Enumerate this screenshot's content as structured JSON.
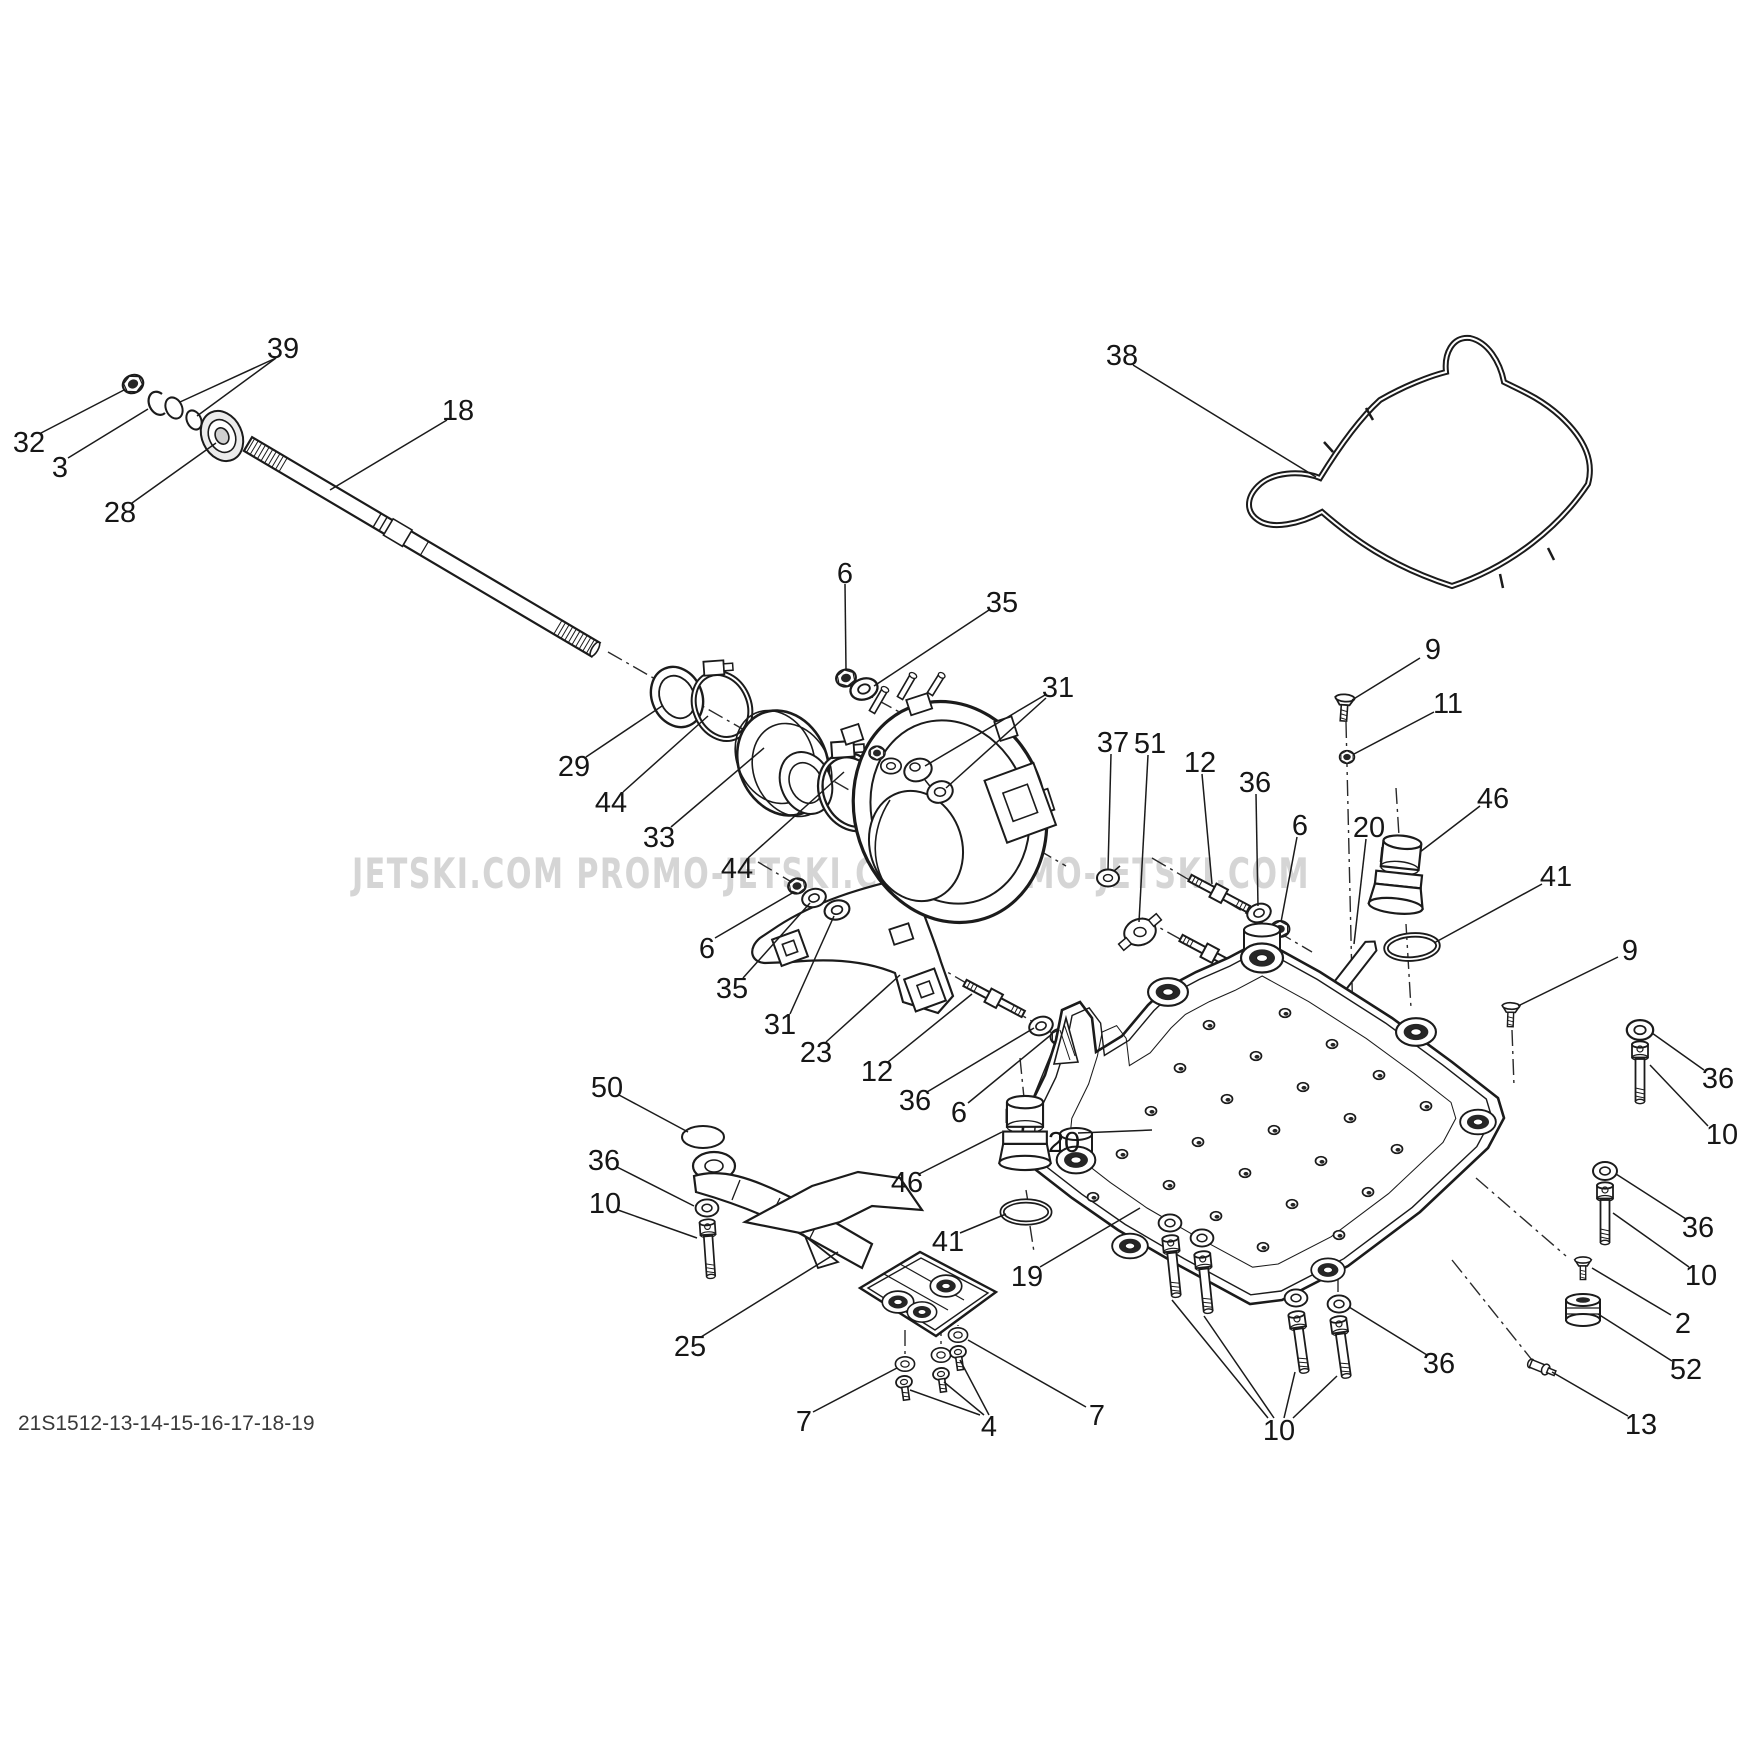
{
  "watermark": {
    "text": "JETSKI.COM PROMO-JETSKI.COM PROMO-JETSKI.COM",
    "color": "#cbcbcb"
  },
  "footer_code": "21S1512-13-14-15-16-17-18-19",
  "diagram": {
    "ink": "#1b1b1b",
    "label_font_px": 29,
    "callouts": [
      {
        "text": "39",
        "x": 283,
        "y": 348,
        "leaders": [
          [
            276,
            358,
            180,
            402
          ],
          [
            276,
            358,
            197,
            416
          ]
        ]
      },
      {
        "text": "32",
        "x": 29,
        "y": 442,
        "leaders": [
          [
            41,
            433,
            124,
            390
          ]
        ]
      },
      {
        "text": "3",
        "x": 60,
        "y": 467,
        "leaders": [
          [
            68,
            458,
            148,
            409
          ]
        ]
      },
      {
        "text": "28",
        "x": 120,
        "y": 512,
        "leaders": [
          [
            132,
            503,
            216,
            443
          ]
        ]
      },
      {
        "text": "18",
        "x": 458,
        "y": 410,
        "leaders": [
          [
            447,
            420,
            330,
            490
          ]
        ]
      },
      {
        "text": "6",
        "x": 845,
        "y": 573,
        "leaders": [
          [
            845,
            584,
            846,
            670
          ]
        ]
      },
      {
        "text": "35",
        "x": 1002,
        "y": 602,
        "leaders": [
          [
            989,
            610,
            874,
            686
          ]
        ]
      },
      {
        "text": "31",
        "x": 1058,
        "y": 687,
        "leaders": [
          [
            1045,
            695,
            925,
            766
          ],
          [
            1046,
            698,
            946,
            788
          ]
        ]
      },
      {
        "text": "29",
        "x": 574,
        "y": 766,
        "leaders": [
          [
            586,
            757,
            662,
            706
          ]
        ]
      },
      {
        "text": "44",
        "x": 611,
        "y": 802,
        "leaders": [
          [
            623,
            792,
            708,
            716
          ]
        ]
      },
      {
        "text": "33",
        "x": 659,
        "y": 837,
        "leaders": [
          [
            671,
            827,
            764,
            748
          ]
        ]
      },
      {
        "text": "44",
        "x": 737,
        "y": 868,
        "leaders": [
          [
            748,
            858,
            844,
            772
          ]
        ]
      },
      {
        "text": "6",
        "x": 707,
        "y": 948,
        "leaders": [
          [
            715,
            938,
            794,
            892
          ]
        ]
      },
      {
        "text": "35",
        "x": 732,
        "y": 988,
        "leaders": [
          [
            743,
            978,
            810,
            903
          ]
        ]
      },
      {
        "text": "31",
        "x": 780,
        "y": 1024,
        "leaders": [
          [
            790,
            1014,
            834,
            916
          ]
        ]
      },
      {
        "text": "23",
        "x": 816,
        "y": 1052,
        "leaders": [
          [
            826,
            1042,
            900,
            975
          ]
        ]
      },
      {
        "text": "37",
        "x": 1113,
        "y": 742,
        "leaders": [
          [
            1111,
            754,
            1108,
            870
          ]
        ]
      },
      {
        "text": "51",
        "x": 1150,
        "y": 743,
        "leaders": [
          [
            1148,
            755,
            1139,
            922
          ]
        ]
      },
      {
        "text": "12",
        "x": 1200,
        "y": 762,
        "leaders": [
          [
            1202,
            774,
            1212,
            884
          ]
        ]
      },
      {
        "text": "36",
        "x": 1255,
        "y": 782,
        "leaders": [
          [
            1256,
            794,
            1258,
            906
          ]
        ]
      },
      {
        "text": "6",
        "x": 1300,
        "y": 825,
        "leaders": [
          [
            1297,
            837,
            1281,
            922
          ]
        ]
      },
      {
        "text": "12",
        "x": 877,
        "y": 1071,
        "leaders": [
          [
            888,
            1062,
            972,
            994
          ]
        ]
      },
      {
        "text": "36",
        "x": 915,
        "y": 1100,
        "leaders": [
          [
            927,
            1092,
            1034,
            1028
          ]
        ]
      },
      {
        "text": "6",
        "x": 959,
        "y": 1112,
        "leaders": [
          [
            968,
            1103,
            1052,
            1034
          ]
        ]
      },
      {
        "text": "9",
        "x": 1433,
        "y": 649,
        "leaders": [
          [
            1420,
            658,
            1352,
            700
          ]
        ]
      },
      {
        "text": "11",
        "x": 1448,
        "y": 703,
        "leaders": [
          [
            1434,
            712,
            1354,
            754
          ]
        ]
      },
      {
        "text": "38",
        "x": 1122,
        "y": 355,
        "leaders": [
          [
            1133,
            365,
            1316,
            477
          ]
        ]
      },
      {
        "text": "46",
        "x": 1493,
        "y": 798,
        "leaders": [
          [
            1480,
            806,
            1420,
            852
          ]
        ]
      },
      {
        "text": "41",
        "x": 1556,
        "y": 876,
        "leaders": [
          [
            1542,
            884,
            1434,
            943
          ]
        ]
      },
      {
        "text": "20",
        "x": 1369,
        "y": 827,
        "leaders": [
          [
            1366,
            839,
            1354,
            944
          ]
        ]
      },
      {
        "text": "9",
        "x": 1630,
        "y": 950,
        "leaders": [
          [
            1618,
            957,
            1518,
            1006
          ]
        ]
      },
      {
        "text": "36",
        "x": 1718,
        "y": 1078,
        "leaders": [
          [
            1704,
            1070,
            1652,
            1033
          ]
        ]
      },
      {
        "text": "10",
        "x": 1722,
        "y": 1134,
        "leaders": [
          [
            1708,
            1126,
            1650,
            1065
          ]
        ]
      },
      {
        "text": "36",
        "x": 1698,
        "y": 1227,
        "leaders": [
          [
            1686,
            1219,
            1616,
            1174
          ]
        ]
      },
      {
        "text": "10",
        "x": 1701,
        "y": 1275,
        "leaders": [
          [
            1689,
            1267,
            1613,
            1213
          ]
        ]
      },
      {
        "text": "2",
        "x": 1683,
        "y": 1323,
        "leaders": [
          [
            1671,
            1315,
            1592,
            1268
          ]
        ]
      },
      {
        "text": "52",
        "x": 1686,
        "y": 1369,
        "leaders": [
          [
            1672,
            1361,
            1598,
            1314
          ]
        ]
      },
      {
        "text": "13",
        "x": 1641,
        "y": 1424,
        "leaders": [
          [
            1628,
            1416,
            1552,
            1372
          ]
        ]
      },
      {
        "text": "36",
        "x": 1439,
        "y": 1363,
        "leaders": [
          [
            1427,
            1355,
            1349,
            1307
          ]
        ]
      },
      {
        "text": "10",
        "x": 1279,
        "y": 1430,
        "leaders": [
          [
            1268,
            1418,
            1172,
            1300
          ],
          [
            1274,
            1418,
            1204,
            1316
          ],
          [
            1284,
            1418,
            1295,
            1372
          ],
          [
            1293,
            1418,
            1337,
            1376
          ]
        ]
      },
      {
        "text": "19",
        "x": 1027,
        "y": 1276,
        "leaders": [
          [
            1040,
            1267,
            1140,
            1208
          ]
        ]
      },
      {
        "text": "20",
        "x": 1064,
        "y": 1142,
        "leaders": [
          [
            1078,
            1133,
            1152,
            1130
          ]
        ]
      },
      {
        "text": "50",
        "x": 607,
        "y": 1087,
        "leaders": [
          [
            619,
            1095,
            688,
            1132
          ]
        ]
      },
      {
        "text": "36",
        "x": 604,
        "y": 1160,
        "leaders": [
          [
            617,
            1167,
            694,
            1206
          ]
        ]
      },
      {
        "text": "10",
        "x": 605,
        "y": 1203,
        "leaders": [
          [
            618,
            1210,
            697,
            1238
          ]
        ]
      },
      {
        "text": "46",
        "x": 907,
        "y": 1182,
        "leaders": [
          [
            919,
            1174,
            1002,
            1132
          ]
        ]
      },
      {
        "text": "41",
        "x": 948,
        "y": 1241,
        "leaders": [
          [
            960,
            1233,
            1006,
            1214
          ]
        ]
      },
      {
        "text": "25",
        "x": 690,
        "y": 1346,
        "leaders": [
          [
            701,
            1337,
            838,
            1252
          ]
        ]
      },
      {
        "text": "7",
        "x": 804,
        "y": 1421,
        "leaders": [
          [
            813,
            1412,
            897,
            1368
          ]
        ]
      },
      {
        "text": "4",
        "x": 989,
        "y": 1426,
        "leaders": [
          [
            980,
            1415,
            910,
            1390
          ],
          [
            984,
            1415,
            944,
            1382
          ],
          [
            989,
            1415,
            960,
            1360
          ]
        ]
      },
      {
        "text": "7",
        "x": 1097,
        "y": 1415,
        "leaders": [
          [
            1086,
            1407,
            968,
            1340
          ]
        ]
      }
    ]
  }
}
